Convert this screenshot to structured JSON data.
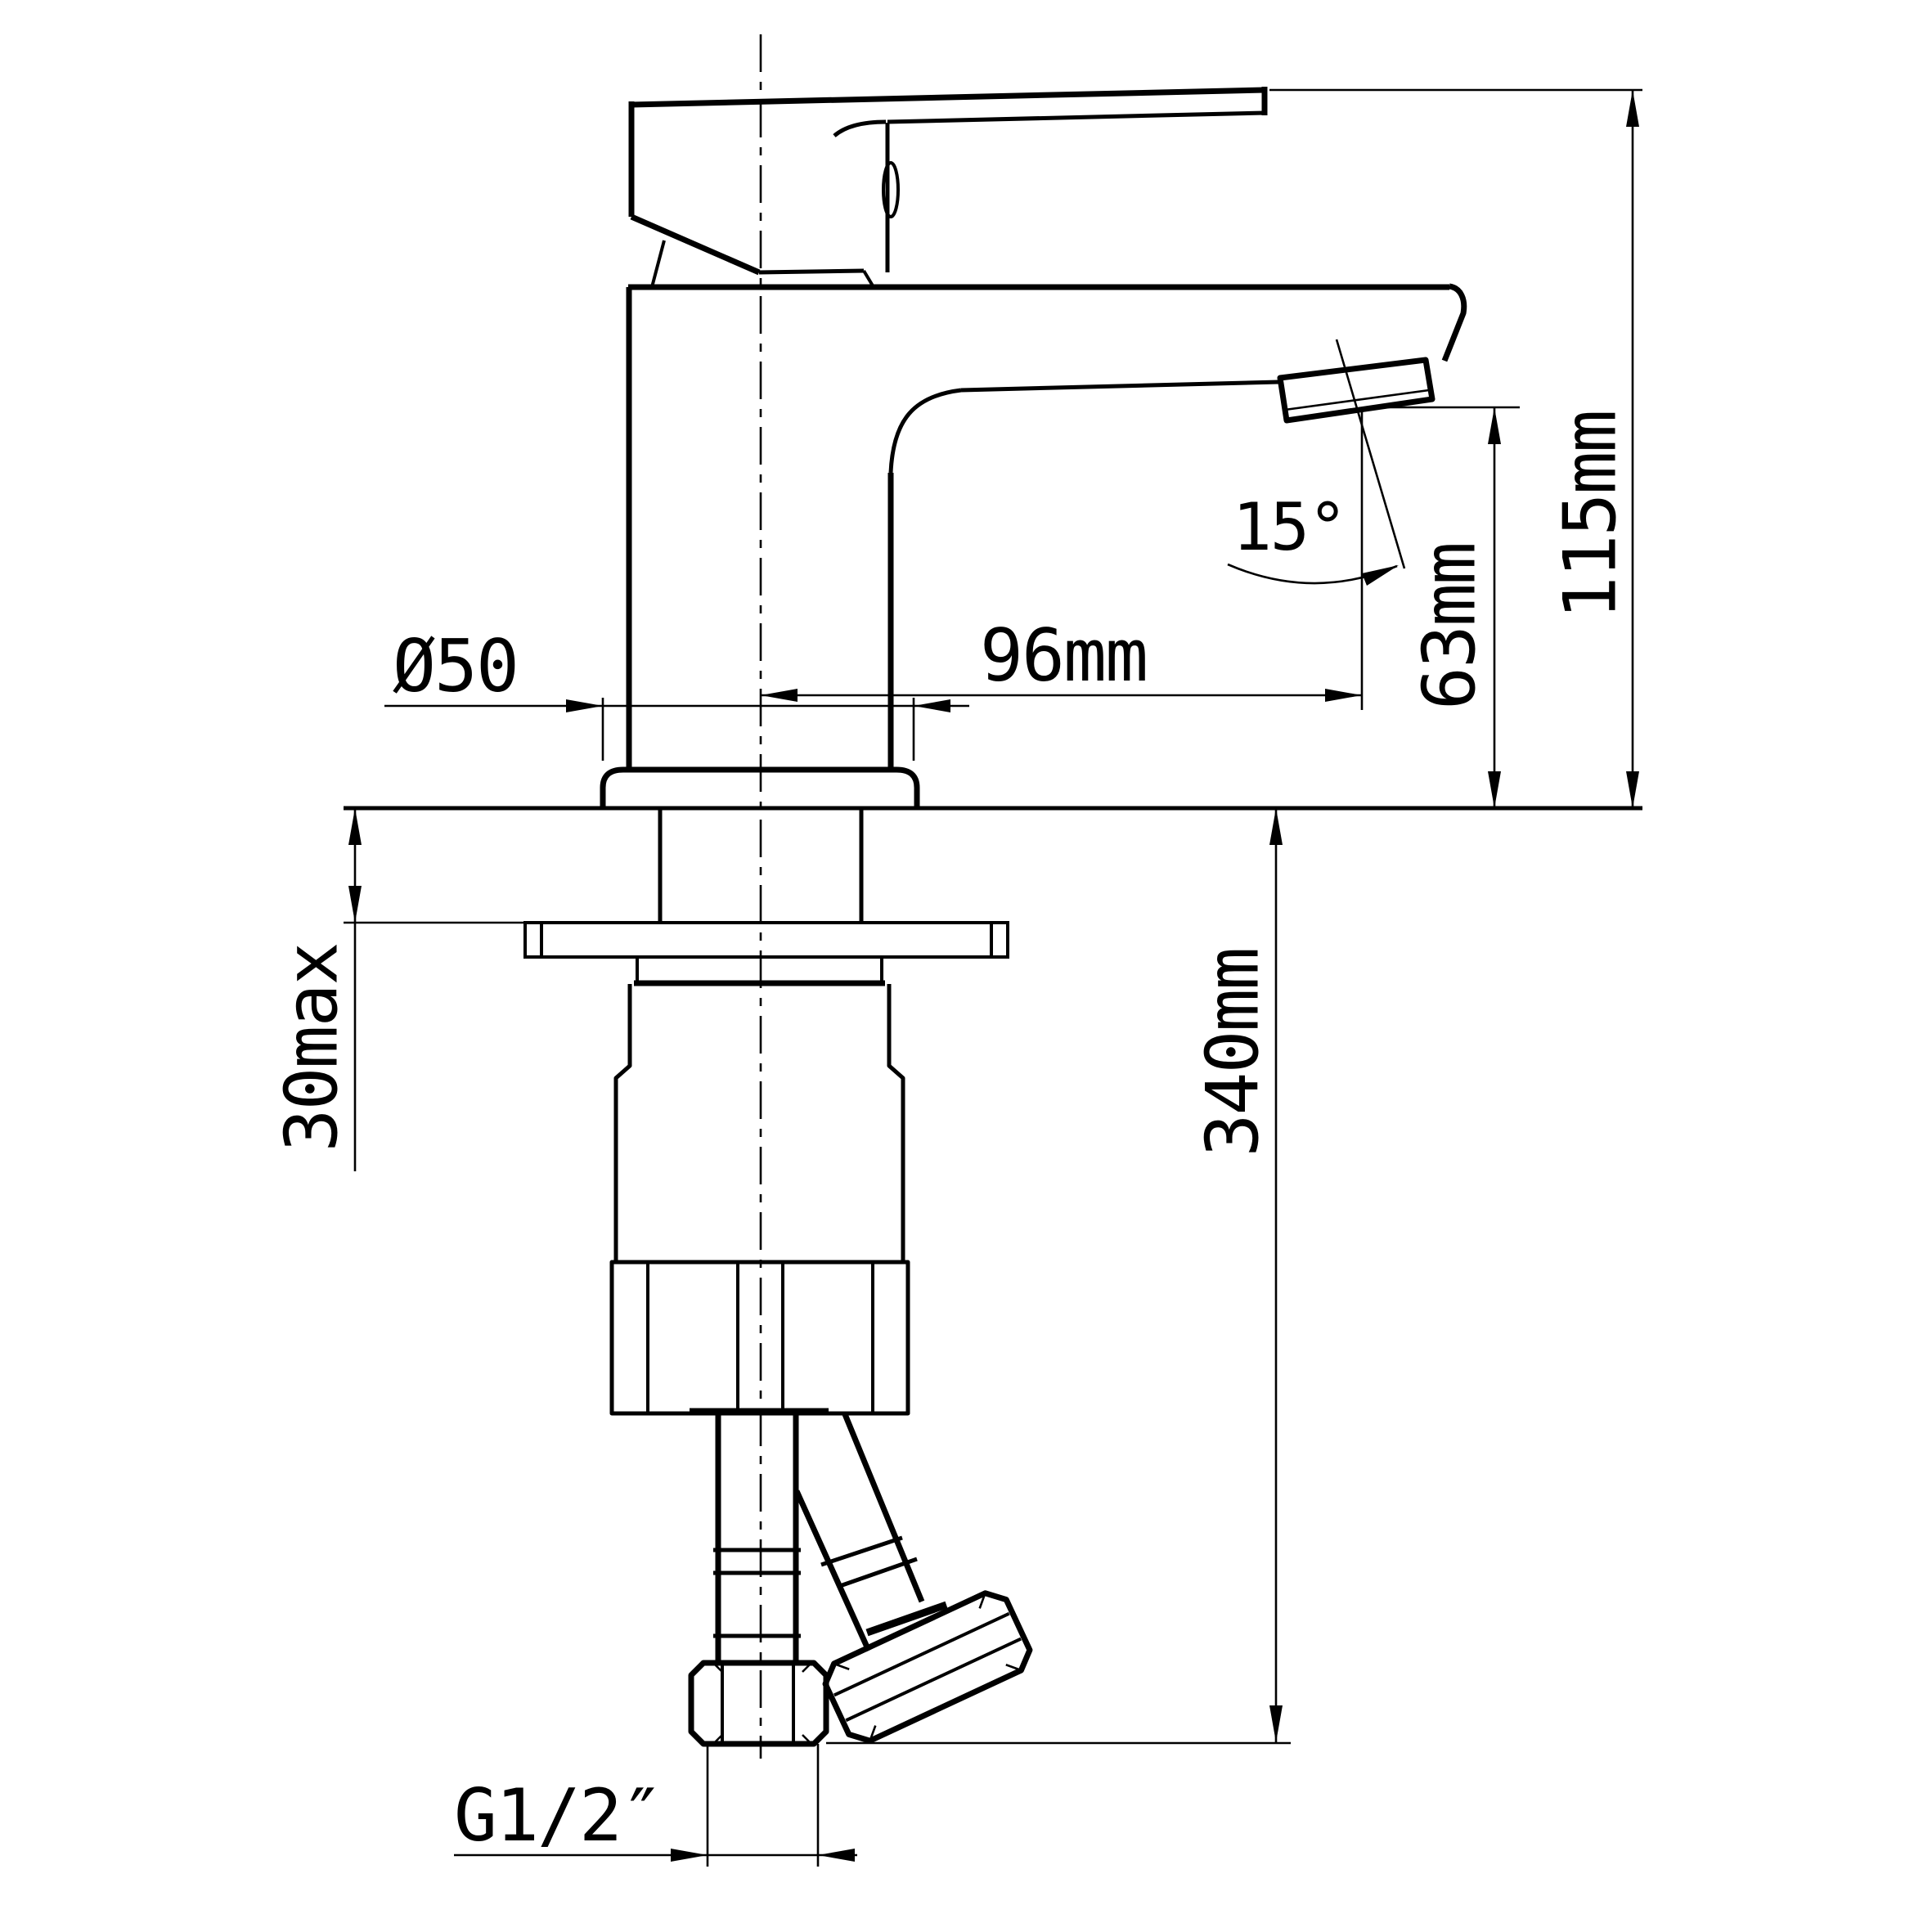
{
  "drawing": {
    "title": "Basin mixer tap - installation dimension drawing",
    "view": "side elevation",
    "colors": {
      "line": "#000000",
      "background": "#ffffff"
    },
    "dimensions": {
      "base_diameter": "Ø50",
      "spout_reach": "96mm",
      "spout_angle": "15°",
      "outlet_height": "63mm",
      "overall_height": "115mm",
      "deck_thickness": "30max",
      "supply_length": "340mm",
      "inlet_thread": "G1/2″"
    }
  }
}
